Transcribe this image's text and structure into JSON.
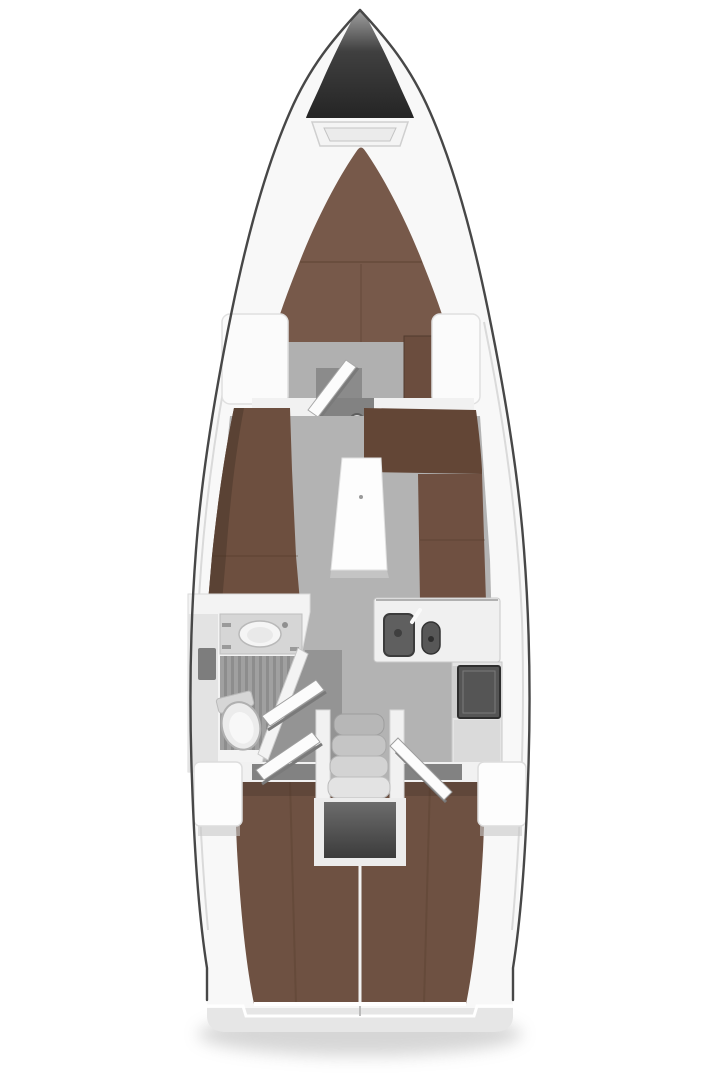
{
  "colors": {
    "background": "#ffffff",
    "hull_fill": "#f8f8f8",
    "hull_outline": "#474747",
    "deck_line": "#dadada",
    "bow_top": "#979797",
    "bow_mid": "#404040",
    "bow_bottom": "#242424",
    "hatch_outer": "#f4f4f4",
    "hatch_inner": "#ebebeb",
    "vberth": "#77594a",
    "berth_seam": "#4a3222",
    "cabin_floor": "#b0b0b0",
    "doorway_dark": "#8b8b8b",
    "wardrobe": "#6b4d3e",
    "locker_white": "#fbfbfb",
    "bulkhead": "#f1f1f1",
    "door_gap": "#828282",
    "door_face": "#fcfcfc",
    "door_shadow": "#7a7a7a",
    "mast_post": "#d6d6d6",
    "salon_floor": "#b3b3b3",
    "settee": "#6d4f3f",
    "settee_back": "#5a4234",
    "settee_l_top": "#634636",
    "settee_l": "#6f5041",
    "table_top": "#fdfdfd",
    "table_shadow": "#cfcfcf",
    "head_wall": "#f3f3f3",
    "head_side_wall": "#e3e3e3",
    "vanity_counter": "#d6d6d6",
    "basin": "#f5f5f5",
    "basin_inner": "#e9e9e9",
    "fixture_rim": "#b0b0b0",
    "toilet": "#ececec",
    "toilet_inner": "#f8f8f8",
    "wall_item": "#7d7d7d",
    "wood_floor_base": "#a0a0a0",
    "wood_floor_stripe": "#8d8d8d",
    "shadow_floor": "#949494",
    "galley_counter": "#f0f0f0",
    "galley_lower": "#e4e4e4",
    "sink_dark": "#5f5f5f",
    "sink_small": "#575757",
    "stove": "#555555",
    "cabinet": "#dadada",
    "step_1": "#b7b7b7",
    "step_2": "#c5c5c5",
    "step_3": "#d3d3d3",
    "step_4": "#e3e3e3",
    "rail": "#f1f1f1",
    "engine_frame": "#ececec",
    "engine_top": "#6e6e6e",
    "engine_dark": "#3a3a3a",
    "aft_berth": "#6e5142",
    "berth_divider": "#f2f2f2",
    "cockpit_block": "#fdfdfd",
    "block_shadow": "#c9c9c9",
    "transom": "#e6e6e6",
    "transom_step": "#ffffff",
    "hull_slot": "#ffffff",
    "boat_shadow": "#9a9a9a"
  }
}
